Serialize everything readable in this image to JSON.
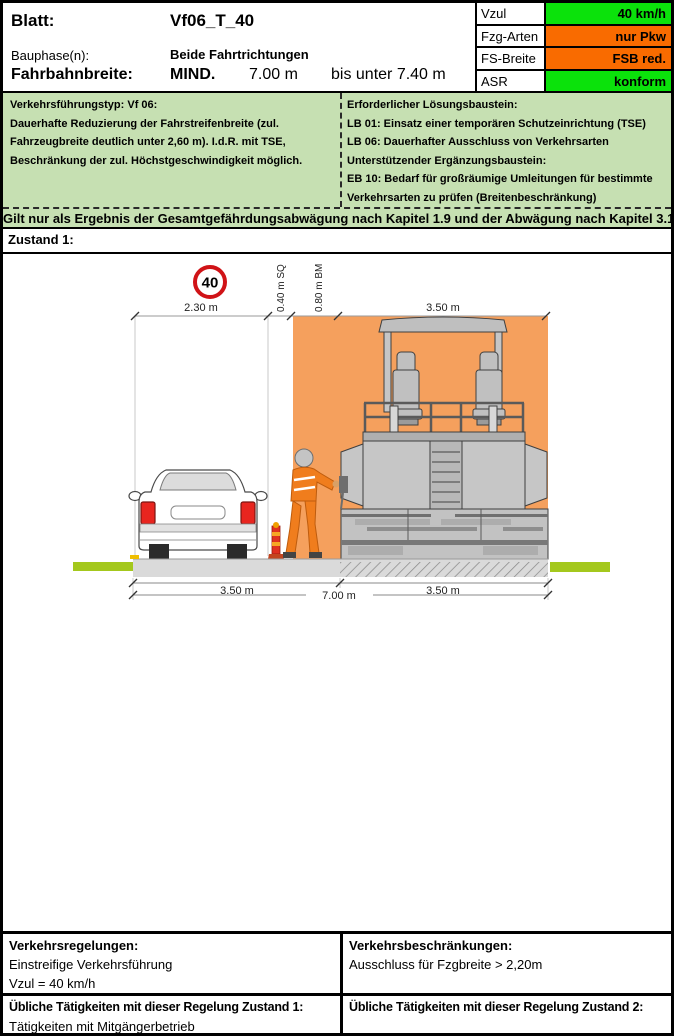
{
  "colors": {
    "status_green": "#0BE20B",
    "status_orange": "#F96B00",
    "info_green": "#C6E0B2",
    "work_zone_orange": "#F5A05D",
    "road_gray": "#DADADA",
    "verge_green": "#A4C81D",
    "sign_red": "#D01317"
  },
  "header": {
    "blatt_label": "Blatt:",
    "blatt_value": "Vf06_T_40",
    "bauphase_label": "Bauphase(n):",
    "bauphase_value": "Beide Fahrtrichtungen",
    "fahrbahn_label": "Fahrbahnbreite:",
    "fahrbahn_mind": "MIND.",
    "fahrbahn_min_value": "7.00 m",
    "fahrbahn_range": "bis unter  7.40 m"
  },
  "status_table": {
    "rows": [
      {
        "label": "Vzul",
        "value": "40 km/h",
        "status": "green"
      },
      {
        "label": "Fzg-Arten",
        "value": "nur Pkw",
        "status": "orange"
      },
      {
        "label": "FS-Breite",
        "value": "FSB red.",
        "status": "orange"
      },
      {
        "label": "ASR",
        "value": "konform",
        "status": "green"
      }
    ]
  },
  "info": {
    "left_lines": [
      "Verkehrsführungstyp: Vf 06:",
      "Dauerhafte Reduzierung der Fahrstreifenbreite (zul.",
      "Fahrzeugbreite deutlich unter 2,60 m). I.d.R. mit TSE,",
      "Beschränkung der zul. Höchstgeschwindigkeit möglich."
    ],
    "right_lines": [
      "Erforderlicher Lösungsbaustein:",
      "LB 01: Einsatz einer temporären Schutzeinrichtung (TSE)",
      "LB 06: Dauerhafter Ausschluss von Verkehrsarten",
      "Unterstützender Ergänzungsbaustein:",
      "EB 10: Bedarf für großräumige Umleitungen für bestimmte",
      "Verkehrsarten zu prüfen (Breitenbeschränkung)"
    ]
  },
  "note": "Gilt nur als Ergebnis der Gesamtgefährdungsabwägung nach Kapitel 1.9 und der Abwägung nach Kapitel 3.1.",
  "zustand_label": "Zustand 1:",
  "diagram": {
    "speed_sign": "40",
    "dim_car_width": "2.30 m",
    "dim_sq": "0.40 m SQ",
    "dim_bm": "0.80 m BM",
    "dim_machine": "3.50 m",
    "dim_lane_left": "3.50 m",
    "dim_lane_right": "3.50 m",
    "dim_total": "7.00 m"
  },
  "bottom": {
    "regelungen_title": "Verkehrsregelungen:",
    "regelungen_line1": "Einstreifige Verkehrsführung",
    "regelungen_line2": "Vzul = 40 km/h",
    "beschraenkungen_title": "Verkehrsbeschränkungen:",
    "beschraenkungen_line1": "Ausschluss für Fzgbreite > 2,20m",
    "taetigkeiten1_title": "Übliche Tätigkeiten mit dieser Regelung Zustand 1:",
    "taetigkeiten1_value": "Tätigkeiten mit Mitgängerbetrieb",
    "taetigkeiten2_title": "Übliche Tätigkeiten mit dieser Regelung Zustand 2:"
  }
}
